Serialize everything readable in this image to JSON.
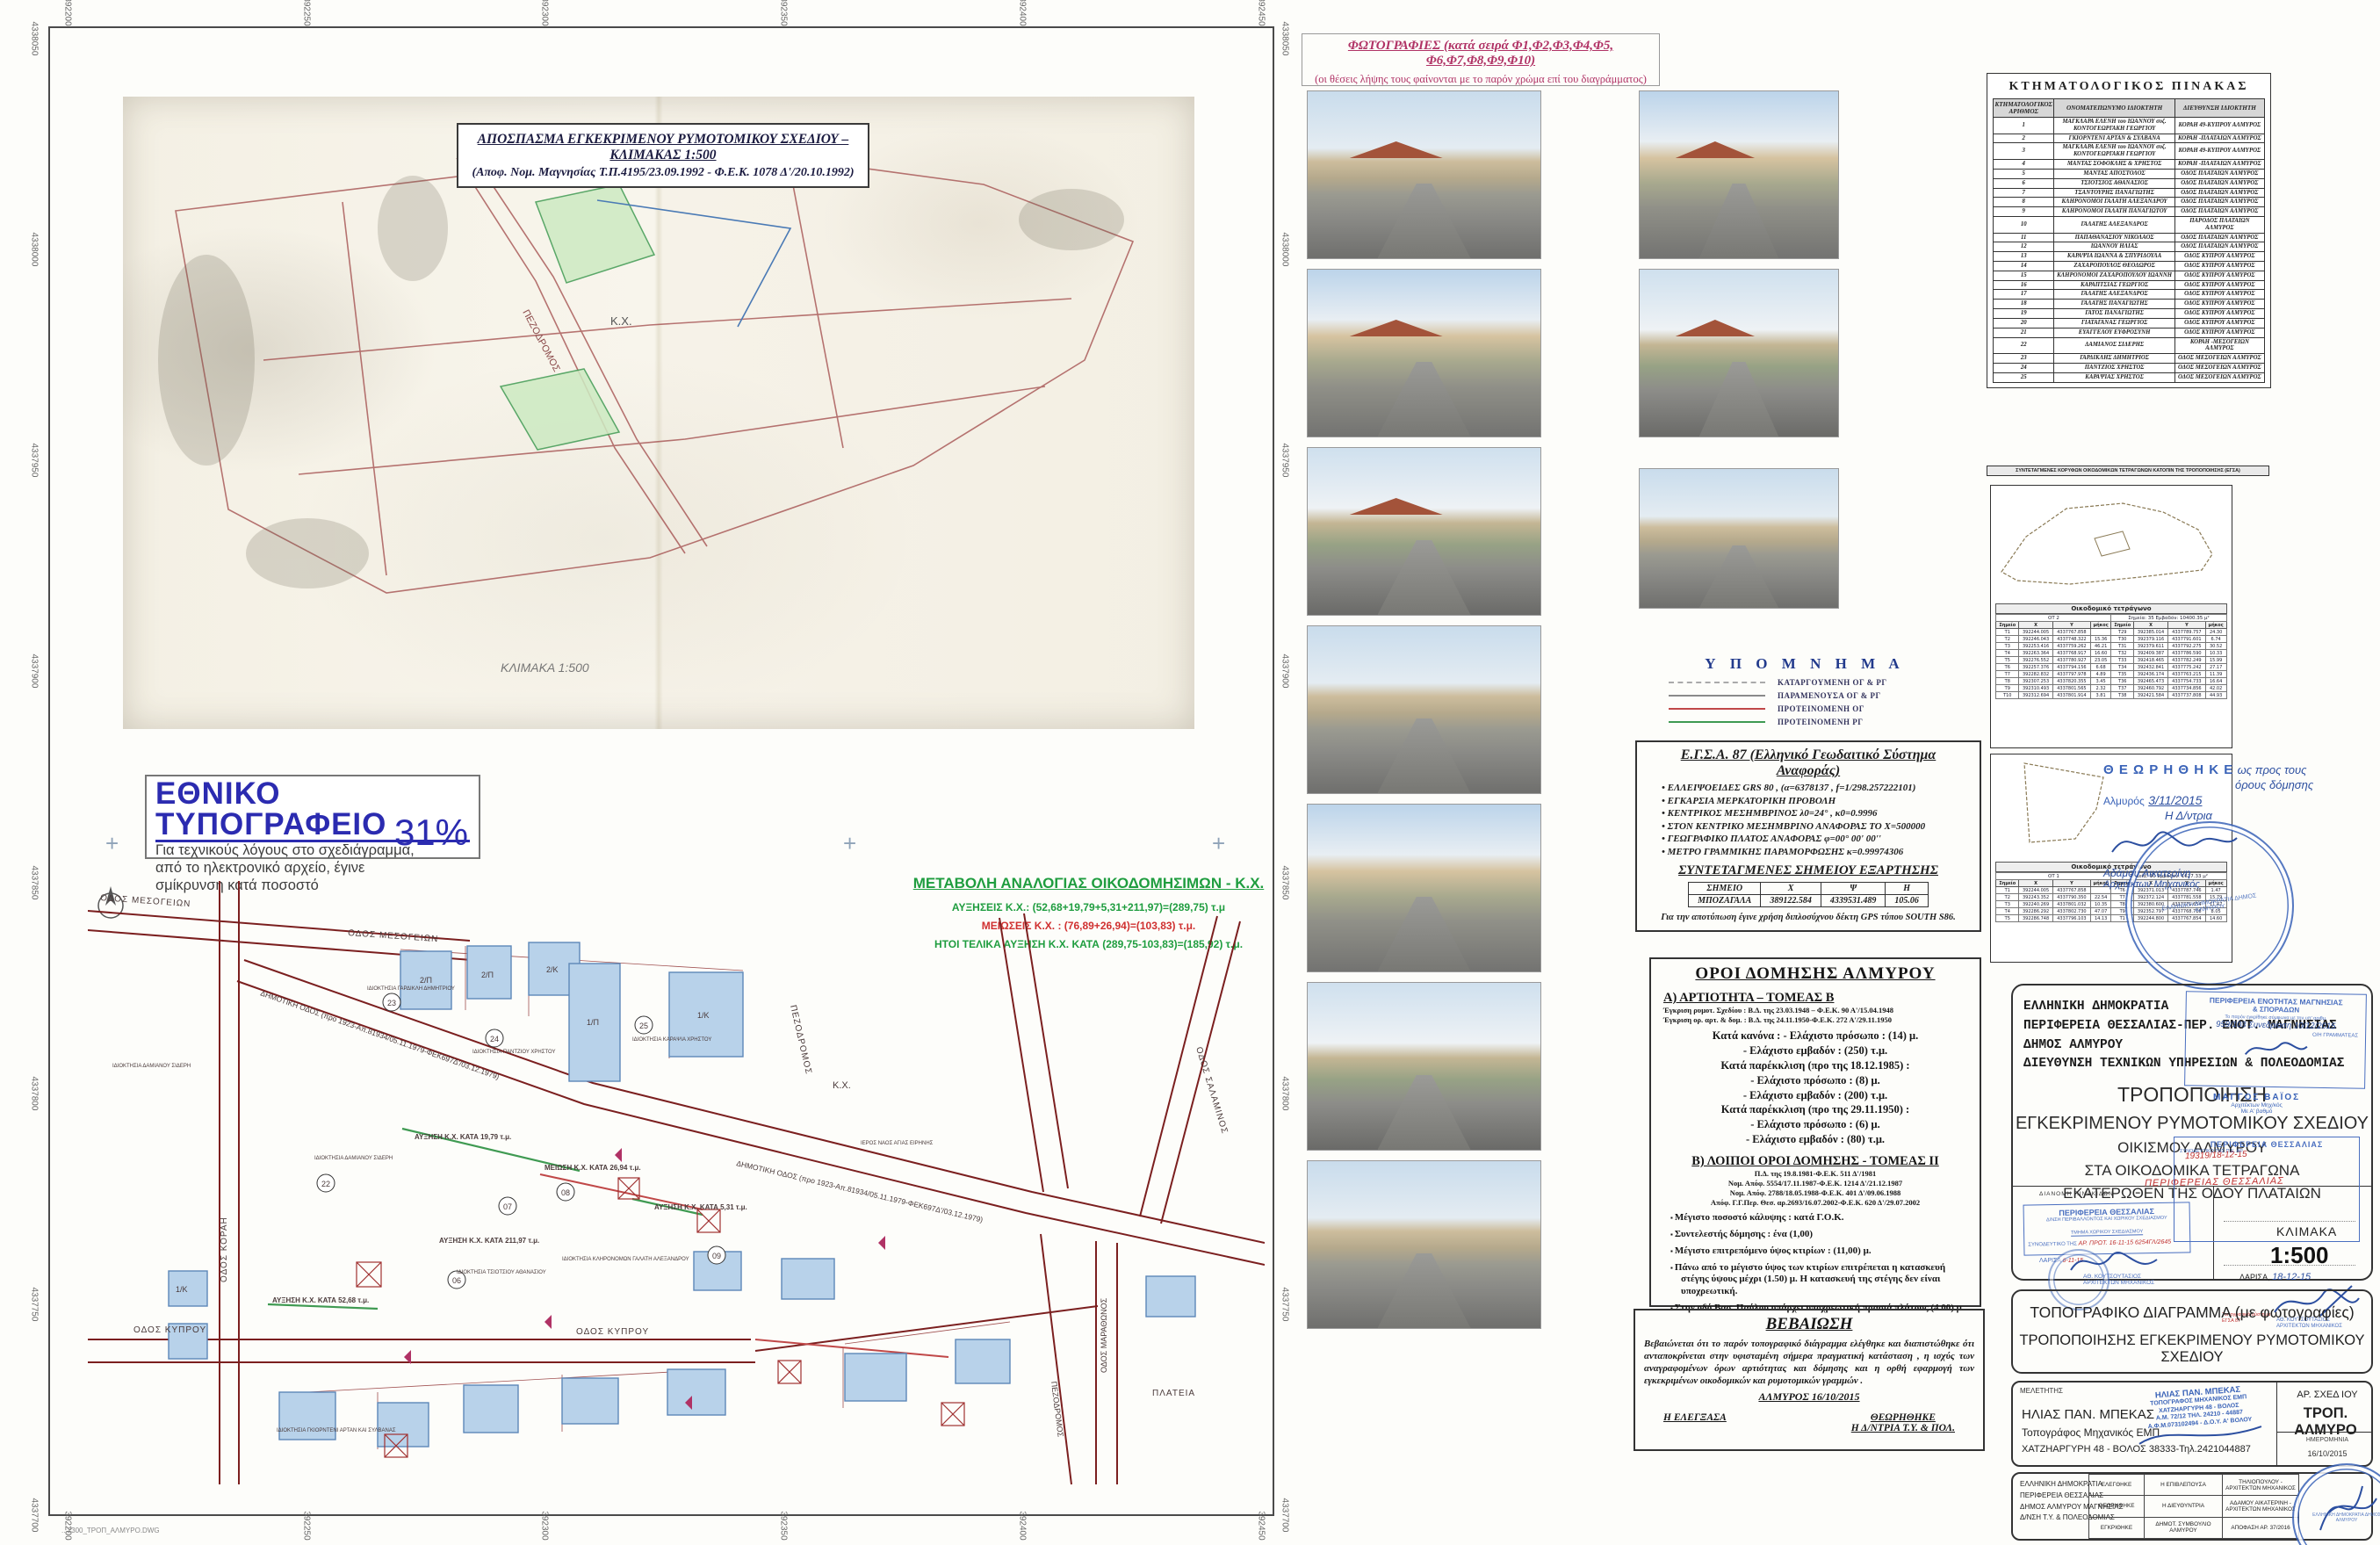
{
  "colors": {
    "proposed_og_red": "#c04848",
    "proposed_rg_green": "#3f9a52",
    "remaining_gray": "#8a8a8a",
    "abolished_gray": "#aaaaaa",
    "accent_green": "#1f9d3f",
    "accent_red": "#d03030",
    "photo_magenta": "#b03265",
    "stamp_blue": "#3a63b8",
    "print_office_blue": "#2b2bb0"
  },
  "frame": {
    "top_coords": [
      "392200",
      "392250",
      "392300",
      "392350",
      "392400",
      "392450"
    ],
    "left_coords": [
      "4338050",
      "4338000",
      "4337950",
      "4337900",
      "4337850",
      "4337800",
      "4337750",
      "4337700"
    ],
    "plot_note": "...2300_ΤΡΟΠ_ΑΛΜΥΡΟ.DWG"
  },
  "excerpt": {
    "title": "ΑΠΟΣΠΑΣΜΑ ΕΓΚΕΚΡΙΜΕΝΟΥ ΡΥΜΟΤΟΜΙΚΟΥ ΣΧΕΔΙΟΥ  –  ΚΛΙΜΑΚΑΣ 1:500",
    "subtitle": "(Αποφ. Νομ. Μαγνησίας Τ.Π.4195/23.09.1992 - Φ.Ε.Κ. 1078 Δ'/20.10.1992)",
    "kx_label": "Κ.Χ.",
    "pezodromos": "ΠΕΖΟΔΡΟΜΟΣ",
    "scale_note": "ΚΛΙΜΑΚΑ 1:500"
  },
  "print_office": {
    "heading": "ΕΘΝΙΚΟ ΤΥΠΟΓΡΑΦΕΙΟ",
    "line1": "Για τεχνικούς λόγους στο σχεδιάγραμμα,",
    "line2": "από το ηλεκτρονικό αρχείο, έγινε",
    "line3": "σμίκρυνση κατά ποσοστό",
    "percent": "31%"
  },
  "metavoli": {
    "title": "ΜΕΤΑΒΟΛΗ ΑΝΑΛΟΓΙΑΣ ΟΙΚΟΔΟΜΗΣΙΜΩΝ - Κ.Χ.",
    "increase": "ΑΥΞΗΣΕΙΣ Κ.Χ.: (52,68+19,79+5,31+211,97)=(289,75) τ.μ",
    "decrease": "ΜΕΙΩΣΕΙΣ Κ.Χ.   :   (76,89+26,94)=(103,83) τ.μ.",
    "total": "ΗΤΟΙ ΤΕΛΙΚΑ ΑΥΞΗΣΗ Κ.Χ. ΚΑΤΑ (289,75-103,83)=(185,92) τ.μ."
  },
  "map": {
    "streets": {
      "mesogeion": "ΟΔΟΣ ΜΕΣΟΓΕΙΩΝ",
      "mesogeion2": "ΟΔΟΣ ΜΕΣΟΓΕΙΩΝ",
      "korai": "ΟΔΟΣ ΚΟΡΑΗ",
      "dimotiki": "ΔΗΜΟΤΙΚΗ ΟΔΟΣ (προ 1923-Απ.81934/05.11.1979-ΦΕΚ697Δ'/03.12.1979)",
      "dimotiki2": "ΔΗΜΟΤΙΚΗ ΟΔΟΣ (προ 1923-Απ.81934/05.11.1979-ΦΕΚ697Δ'/03.12.1979)",
      "pezodromos": "ΠΕΖΟΔΡΟΜΟΣ",
      "pezodromos2": "ΠΕΖΟΔΡΟΜΟΣ",
      "salaminos": "ΟΔΟΣ ΣΑΛΑΜΙΝΟΣ",
      "kyprou": "ΟΔΟΣ ΚΥΠΡΟΥ",
      "kyprou2": "ΟΔΟΣ ΚΥΠΡΟΥ",
      "marathonos": "ΟΔΟΣ ΜΑΡΑΘΩΝΟΣ",
      "plateia": "ΠΛΑΤΕΙΑ",
      "kx": "Κ.Χ."
    },
    "annotations": {
      "inc1": "ΑΥΞΗΣΗ Κ.Χ. ΚΑΤΑ 19,79 τ.μ.",
      "inc2": "ΑΥΞΗΣΗ Κ.Χ. ΚΑΤΑ 5,31 τ.μ.",
      "inc3": "ΑΥΞΗΣΗ Κ.Χ. ΚΑΤΑ 52,68 τ.μ.",
      "inc4": "ΑΥΞΗΣΗ Κ.Χ. ΚΑΤΑ 211,97 τ.μ.",
      "dec1": "ΜΕΙΩΣΗ Κ.Χ. ΚΑΤΑ 26,94 τ.μ.",
      "church": "ΙΕΡΟΣ ΝΑΟΣ ΑΓΙΑΣ ΕΙΡΗΝΗΣ",
      "prop_sideri": "ΙΔΙΟΚΤΗΣΙΑ ΔΑΜΙΑΝΟΥ ΣΙΔΕΡΗ",
      "prop_sideri2": "ΙΔΙΟΚΤΗΣΙΑ ΔΑΜΙΑΝΟΥ ΣΙΔΕΡΗ",
      "prop_gardikli": "ΙΔΙΟΚΤΗΣΙΑ ΓΑΡΔΙΚΛΗ ΔΗΜΗΤΡΙΟΥ",
      "prop_pantziou": "ΙΔΙΟΚΤΗΣΙΑ ΠΑΝΤΖΙΟΥ ΧΡΗΣΤΟΥ",
      "prop_karapsia": "ΙΔΙΟΚΤΗΣΙΑ ΚΑΡΑΨΙΑ ΧΡΗΣΤΟΥ",
      "prop_galati": "ΙΔΙΟΚΤΗΣΙΑ ΚΛΗΡΟΝΟΜΩΝ ΓΑΛΑΤΗ ΑΛΕΞΑΝΔΡΟΥ",
      "prop_tsiotsiou": "ΙΔΙΟΚΤΗΣΙΑ ΤΣΙΟΤΣΙΟΥ ΑΘΑΝΑΣΙΟΥ",
      "prop_gkiornteni": "ΙΔΙΟΚΤΗΣΙΑ ΓΚΙΟΡΝΤΕΝΙ ΑΡΤΑΝ ΚΑΙ ΣΥΛΒΑΝΑΣ"
    },
    "lot_numbers": [
      "06",
      "07",
      "08",
      "09",
      "22",
      "23",
      "24",
      "25"
    ],
    "lot_tags": [
      "2/Π",
      "2/Π",
      "2/Κ",
      "1/Π",
      "1/Κ",
      "1/Κ"
    ]
  },
  "photos": {
    "header": "ΦΩΤΟΓΡΑΦΙΕΣ (κατά σειρά Φ1,Φ2,Φ3,Φ4,Φ5, Φ6,Φ7,Φ8,Φ9,Φ10)",
    "subheader": "(οι θέσεις λήψης τους φαίνονται με το παρόν χρώμα επί του διαγράμματος)"
  },
  "legend": {
    "title": "Υ Π Ο Μ Ν Η Μ Α",
    "items": [
      {
        "label": "ΚΑΤΑΡΓΟΥΜΕΝΗ ΟΓ & ΡΓ"
      },
      {
        "label": "ΠΑΡΑΜΕΝΟΥΣΑ ΟΓ & ΡΓ"
      },
      {
        "label": "ΠΡΟΤΕΙΝΟΜΕΝΗ ΟΓ"
      },
      {
        "label": "ΠΡΟΤΕΙΝΟΜΕΝΗ ΡΓ"
      }
    ]
  },
  "egsa": {
    "title": "Ε.Γ.Σ.Α. 87 (Ελληνικό Γεωδαιτικό Σύστημα Αναφοράς)",
    "bullets": [
      "ΕΛΛΕΙΨΟΕΙΔΕΣ GRS 80 , (α=6378137 , f=1/298.257222101)",
      "ΕΓΚΑΡΣΙΑ ΜΕΡΚΑΤΟΡΙΚΗ ΠΡΟΒΟΛΗ",
      "ΚΕΝΤΡΙΚΟΣ ΜΕΣΗΜΒΡΙΝΟΣ λ0=24° , κ0=0.9996",
      "ΣΤΟΝ ΚΕΝΤΡΙΚΟ ΜΕΣΗΜΒΡΙΝΟ ΑΝΑΦΟΡΑΣ ΤΟ Χ=500000",
      "ΓΕΩΓΡΑΦΙΚΟ ΠΛΑΤΟΣ ΑΝΑΦΟΡΑΣ  φ=00° 00' 00''",
      "ΜΕΤΡΟ ΓΡΑΜΜΙΚΗΣ ΠΑΡΑΜΟΡΦΩΣΗΣ  κ=0.99974306"
    ],
    "coords_title": "ΣΥΝΤΕΤΑΓΜΕΝΕΣ ΣΗΜΕΙΟΥ ΕΞΑΡΤΗΣΗΣ",
    "table": {
      "h0": "ΣΗΜΕΙΟ",
      "h1": "Χ",
      "h2": "Ψ",
      "h3": "Η",
      "r0": "ΜΠΟΖΑΓΑΛΑ",
      "r1": "389122.584",
      "r2": "4339531.489",
      "r3": "105.06"
    },
    "note": "Για την αποτύπωση έγινε χρήση διπλοσύχνου δέκτη GPS τύπου SOUTH S86."
  },
  "oroi": {
    "title": "ΟΡΟΙ ΔΟΜΗΣΗΣ ΑΛΜΥΡΟΥ",
    "sectionA_title": "Α) ΑΡΤΙΟΤΗΤΑ – ΤΟΜΕΑΣ Β",
    "sectionA_refs": [
      "Έγκριση ρυμοτ. Σχεδίου : Β.Δ. της 23.03.1948 – Φ.Ε.Κ. 90 Α'/15.04.1948",
      "Έγκριση ορ. αρτ. & δομ. : Β.Δ. της 24.11.1950-Φ.Ε.Κ. 272 Α'/29.11.1950"
    ],
    "rules": [
      "Κατά κανόνα : - Ελάχιστο πρόσωπο  : (14) μ.",
      "- Ελάχιστο εμβαδόν    : (250) τ.μ.",
      "Κατά παρέκκλιση (προ της 18.12.1985)  :",
      "- Ελάχιστο πρόσωπο  : (8) μ.",
      "- Ελάχιστο εμβαδόν    : (200) τ.μ.",
      "Κατά παρέκκλιση (προ της 29.11.1950)  :",
      "- Ελάχιστο πρόσωπο  : (6) μ.",
      "- Ελάχιστο εμβαδόν  : (80) τ.μ."
    ],
    "sectionB_title": "Β) ΛΟΙΠΟΙ ΟΡΟΙ ΔΟΜΗΣΗΣ - ΤΟΜΕΑΣ ΙΙ",
    "sectionB_refs": [
      "Π.Δ. της 19.8.1981-Φ.Ε.Κ. 511 Δ'/1981",
      "Νομ. Απόφ. 5554/17.11.1987-Φ.Ε.Κ. 1214 Δ'/21.12.1987",
      "Νομ. Απόφ. 2788/18.05.1988-Φ.Ε.Κ.  401 Δ'/09.06.1988",
      "Απόφ. Γ.Γ.Περ. Θεσ. αρ.2693/16.07.2002-Φ.Ε.Κ. 620 Δ'/29.07.2002"
    ],
    "sectionB_bullets": [
      "Μέγιστο ποσοστό κάλυψης : κατά Γ.Ο.Κ.",
      "Συντελεστής δόμησης :  ένα (1,00)",
      "Μέγιστο επιτρεπόμενο ύψος κτιρίων : (11,00) μ.",
      "Πάνω από το μέγιστο ύψος των κτιρίων επιτρέπεται η κατασκευή στέγης ύψους μέχρι (1.50) μ.  Η κατασκευή της στέγης δεν είναι υποχρεωτική.",
      "Στην οδό Βασ. Παύλου υπάρχει υποχρεωτική πρασιά πλάτους  (4.00) μ."
    ]
  },
  "vevaiosi": {
    "title": "ΒΕΒΑΙΩΣΗ",
    "body": "Βεβαιώνεται ότι το παρόν τοπογραφικό διάγραμμα ελέγθηκε και διαπιστώθηκε ότι ανταποκρίνεται στην υφισταμένη σήμερα πραγματική κατάσταση , η ισχύς των αναγραφομένων όρων αρτιότητας και δόμησης και η ορθή εφαρμογή των εγκεκριμένων οικοδομικών και ρυμοτομικών γραμμών .",
    "place_date": "ΑΛΜΥΡΟΣ  16/10/2015",
    "left_sign": "Η  ΕΛΕΓΞΑΣΑ",
    "right_sign1": "ΘΕΩΡΗΘΗΚΕ",
    "right_sign2": "Η  Δ/ΝΤΡΙΑ Τ.Υ. & ΠΟΛ."
  },
  "ktimatologikos": {
    "title": "ΚΤΗΜΑΤΟΛΟΓΙΚΟΣ   ΠΙΝΑΚΑΣ",
    "h0": "ΚΤΗΜΑΤΟΛΟΓΙΚΟΣ ΑΡΙΘΜΟΣ",
    "h1": "ΟΝΟΜΑΤΕΠΩΝΥΜΟ ΙΔΙΟΚΤΗΤΗ",
    "h2": "ΔΙΕΥΘΥΝΣΗ ΙΔΙΟΚΤΗΤΗ",
    "rows": [
      {
        "n": "1",
        "owner": "ΜΑΓΚΛΑΡΑ ΕΛΕΝΗ του ΙΩΑΝΝΟΥ συζ. ΚΟΝΤΟΓΕΩΡΓΑΚΗ ΓΕΩΡΓΙΟΥ",
        "addr": "ΚΟΡΑΗ 49-ΚΥΠΡΟΥ ΑΛΜΥΡΟΣ"
      },
      {
        "n": "2",
        "owner": "ΓΚΙΟΡΝΤΕΝΙ ΑΡΤΑΝ & ΣΥΛΒΑΝΑ",
        "addr": "ΚΟΡΑΗ -ΠΛΑΤΑΙΩΝ ΑΛΜΥΡΟΣ"
      },
      {
        "n": "3",
        "owner": "ΜΑΓΚΛΑΡΑ ΕΛΕΝΗ του ΙΩΑΝΝΟΥ συζ. ΚΟΝΤΟΓΕΩΡΓΑΚΗ ΓΕΩΡΓΙΟΥ",
        "addr": "ΚΟΡΑΗ 49-ΚΥΠΡΟΥ ΑΛΜΥΡΟΣ"
      },
      {
        "n": "4",
        "owner": "ΜΑΝΤΑΣ ΣΟΦΟΚΛΗΣ & ΧΡΗΣΤΟΣ",
        "addr": "ΚΟΡΑΗ -ΠΛΑΤΑΙΩΝ ΑΛΜΥΡΟΣ"
      },
      {
        "n": "5",
        "owner": "ΜΑΝΤΑΣ ΑΠΟΣΤΟΛΟΣ",
        "addr": "ΟΔΟΣ ΠΛΑΤΑΙΩΝ ΑΛΜΥΡΟΣ"
      },
      {
        "n": "6",
        "owner": "ΤΣΙΟΤΣΙΟΣ ΑΘΑΝΑΣΙΟΣ",
        "addr": "ΟΔΟΣ ΠΛΑΤΑΙΩΝ ΑΛΜΥΡΟΣ"
      },
      {
        "n": "7",
        "owner": "ΤΣΑΝΤΟΥΡΗΣ ΠΑΝΑΓΙΩΤΗΣ",
        "addr": "ΟΔΟΣ ΠΛΑΤΑΙΩΝ ΑΛΜΥΡΟΣ"
      },
      {
        "n": "8",
        "owner": "ΚΛΗΡΟΝΟΜΟΙ ΓΑΛΑΤΗ ΑΛΕΞΑΝΔΡΟΥ",
        "addr": "ΟΔΟΣ ΠΛΑΤΑΙΩΝ ΑΛΜΥΡΟΣ"
      },
      {
        "n": "9",
        "owner": "ΚΛΗΡΟΝΟΜΟΙ ΓΑΛΑΤΗ ΠΑΝΑΓΙΩΤΟΥ",
        "addr": "ΟΔΟΣ ΠΛΑΤΑΙΩΝ ΑΛΜΥΡΟΣ"
      },
      {
        "n": "10",
        "owner": "ΓΑΛΑΤΗΣ ΑΛΕΞΑΝΔΡΟΣ",
        "addr": "ΠΑΡΟΔΟΣ ΠΛΑΤΑΙΩΝ ΑΛΜΥΡΟΣ"
      },
      {
        "n": "11",
        "owner": "ΠΑΠΑΘΑΝΑΣΙΟΥ ΝΙΚΟΛΑΟΣ",
        "addr": "ΟΔΟΣ ΠΛΑΤΑΙΩΝ ΑΛΜΥΡΟΣ"
      },
      {
        "n": "12",
        "owner": "ΙΩΑΝΝΟΥ ΗΛΙΑΣ",
        "addr": "ΟΔΟΣ ΠΛΑΤΑΙΩΝ ΑΛΜΥΡΟΣ"
      },
      {
        "n": "13",
        "owner": "ΚΑΡΑΨΙΑ ΙΩΑΝΝΑ & ΣΠΥΡΙΔΟΥΛΑ",
        "addr": "ΟΔΟΣ ΚΥΠΡΟΥ ΑΛΜΥΡΟΣ"
      },
      {
        "n": "14",
        "owner": "ΖΑΧΑΡΟΠΟΥΛΟΣ ΘΕΟΔΩΡΟΣ",
        "addr": "ΟΔΟΣ ΚΥΠΡΟΥ ΑΛΜΥΡΟΣ"
      },
      {
        "n": "15",
        "owner": "ΚΛΗΡΟΝΟΜΟΙ ΖΑΧΑΡΟΠΟΥΛΟΥ ΙΩΑΝΝΗ",
        "addr": "ΟΔΟΣ ΚΥΠΡΟΥ ΑΛΜΥΡΟΣ"
      },
      {
        "n": "16",
        "owner": "ΚΑΡΑΠΤΣΙΑΣ ΓΕΩΡΓΙΟΣ",
        "addr": "ΟΔΟΣ ΚΥΠΡΟΥ ΑΛΜΥΡΟΣ"
      },
      {
        "n": "17",
        "owner": "ΓΑΛΑΤΗΣ ΑΛΕΞΑΝΔΡΟΣ",
        "addr": "ΟΔΟΣ ΚΥΠΡΟΥ ΑΛΜΥΡΟΣ"
      },
      {
        "n": "18",
        "owner": "ΓΑΛΑΤΗΣ ΠΑΝΑΓΙΩΤΗΣ",
        "addr": "ΟΔΟΣ ΚΥΠΡΟΥ ΑΛΜΥΡΟΣ"
      },
      {
        "n": "19",
        "owner": "ΓΑΤΟΣ ΠΑΝΑΓΙΩΤΗΣ",
        "addr": "ΟΔΟΣ ΚΥΠΡΟΥ ΑΛΜΥΡΟΣ"
      },
      {
        "n": "20",
        "owner": "ΓΙΑΤΑΓΑΝΑΣ ΓΕΩΡΓΙΟΣ",
        "addr": "ΟΔΟΣ ΚΥΠΡΟΥ ΑΛΜΥΡΟΣ"
      },
      {
        "n": "21",
        "owner": "ΕΥΑΓΓΕΛΟΥ ΕΥΦΡΟΣΥΝΗ",
        "addr": "ΟΔΟΣ ΚΥΠΡΟΥ ΑΛΜΥΡΟΣ"
      },
      {
        "n": "22",
        "owner": "ΔΑΜΙΑΝΟΣ ΣΙΔΕΡΗΣ",
        "addr": "ΚΟΡΑΗ -ΜΕΣΟΓΕΙΩΝ ΑΛΜΥΡΟΣ"
      },
      {
        "n": "23",
        "owner": "ΓΑΡΔΙΚΛΗΣ ΔΗΜΗΤΡΙΟΣ",
        "addr": "ΟΔΟΣ ΜΕΣΟΓΕΙΩΝ ΑΛΜΥΡΟΣ"
      },
      {
        "n": "24",
        "owner": "ΠΑΝΤΖΙΟΣ ΧΡΗΣΤΟΣ",
        "addr": "ΟΔΟΣ ΜΕΣΟΓΕΙΩΝ ΑΛΜΥΡΟΣ"
      },
      {
        "n": "25",
        "owner": "ΚΑΡΑΨΙΑΣ ΧΡΗΣΤΟΣ",
        "addr": "ΟΔΟΣ ΜΕΣΟΓΕΙΩΝ ΑΛΜΥΡΟΣ"
      }
    ],
    "footer": "ΣΥΝΤΕΤΑΓΜΕΝΕΣ ΚΟΡΥΦΩΝ ΟΙΚΟΔΟΜΙΚΩΝ ΤΕΤΡΑΓΩΝΩΝ ΚΑΤΟΠΙΝ ΤΗΣ ΤΡΟΠΟΠΟΙΗΣΗΣ (ΕΓΣΑ)"
  },
  "ot_panels": {
    "p1": {
      "caption": "Οικοδομικό τετράγωνο",
      "info_left": "ΟΤ 2",
      "info_right": "Σημεία: 35     Εμβαδόν: 10400.35 μ²",
      "h_point": "Σημείο",
      "h_x": "Χ",
      "h_y": "Υ",
      "h_len": "μήκος",
      "rows_a": [
        {
          "p": "Τ1",
          "x": "392244.005",
          "y": "4337767.858",
          "l": ""
        },
        {
          "p": "Τ2",
          "x": "392246.043",
          "y": "4337748.322",
          "l": "15.36"
        },
        {
          "p": "Τ3",
          "x": "392253.416",
          "y": "4337759.262",
          "l": "46.21"
        },
        {
          "p": "Τ4",
          "x": "392263.364",
          "y": "4337768.917",
          "l": "16.60"
        },
        {
          "p": "Τ5",
          "x": "392276.552",
          "y": "4337780.927",
          "l": "23.05"
        },
        {
          "p": "Τ6",
          "x": "392257.376",
          "y": "4337794.156",
          "l": "6.68"
        },
        {
          "p": "Τ7",
          "x": "392282.832",
          "y": "4337797.978",
          "l": "4.89"
        },
        {
          "p": "Τ8",
          "x": "392307.253",
          "y": "4337820.355",
          "l": "3.45"
        },
        {
          "p": "Τ9",
          "x": "392310.493",
          "y": "4337801.565",
          "l": "2.32"
        },
        {
          "p": "Τ10",
          "x": "392312.694",
          "y": "4337801.914",
          "l": "3.81"
        }
      ],
      "rows_b": [
        {
          "p": "Τ29",
          "x": "392385.014",
          "y": "4337789.757",
          "l": "24.30"
        },
        {
          "p": "Τ30",
          "x": "392379.116",
          "y": "4337791.601",
          "l": "6.74"
        },
        {
          "p": "Τ31",
          "x": "392379.611",
          "y": "4337792.275",
          "l": "30.52"
        },
        {
          "p": "Τ32",
          "x": "392409.387",
          "y": "4337786.590",
          "l": "10.33"
        },
        {
          "p": "Τ33",
          "x": "392418.465",
          "y": "4337782.249",
          "l": "15.99"
        },
        {
          "p": "Τ34",
          "x": "392432.841",
          "y": "4337775.242",
          "l": "27.17"
        },
        {
          "p": "Τ35",
          "x": "392436.174",
          "y": "4337763.215",
          "l": "11.39"
        },
        {
          "p": "Τ36",
          "x": "392465.473",
          "y": "4337754.733",
          "l": "16.64"
        },
        {
          "p": "Τ37",
          "x": "392460.792",
          "y": "4337734.856",
          "l": "42.02"
        },
        {
          "p": "Τ38",
          "x": "392421.584",
          "y": "4337737.808",
          "l": "44.93"
        }
      ]
    },
    "p2": {
      "caption": "Οικοδομικό τετράγωνο",
      "info_left": "ΟΤ 1",
      "info_right": "Σημεία: 10     Εμβαδόν: 1627.33 μ²",
      "h_point": "Σημείο",
      "h_x": "Χ",
      "h_y": "Υ",
      "h_len": "μήκος",
      "rows_a": [
        {
          "p": "Τ1",
          "x": "392244.005",
          "y": "4337767.858",
          "l": ""
        },
        {
          "p": "Τ2",
          "x": "392243.352",
          "y": "4337790.350",
          "l": "22.54"
        },
        {
          "p": "Τ3",
          "x": "392240.269",
          "y": "4337801.032",
          "l": "10.35"
        },
        {
          "p": "Τ4",
          "x": "392286.292",
          "y": "4337802.730",
          "l": "47.07"
        },
        {
          "p": "Τ5",
          "x": "392286.748",
          "y": "4337796.103",
          "l": "14.13"
        }
      ],
      "rows_b": [
        {
          "p": "Τ6",
          "x": "392371.013",
          "y": "4337787.746",
          "l": "1.47"
        },
        {
          "p": "Τ7",
          "x": "392372.124",
          "y": "4337781.558",
          "l": "15.79"
        },
        {
          "p": "Τ8",
          "x": "392380.600",
          "y": "4337771.654",
          "l": "11.47"
        },
        {
          "p": "Τ9",
          "x": "392352.797",
          "y": "4337768.718",
          "l": "8.05"
        },
        {
          "p": "Τ1",
          "x": "392244.800",
          "y": "4337767.854",
          "l": "14.60"
        }
      ]
    }
  },
  "theorisi": {
    "line1": "Θ Ε Ω Ρ Η Θ Η Κ Ε",
    "hand1": "ως προς τους",
    "hand2": "όρους δόμησης",
    "line2": "Αλμυρός",
    "hand_date": "3/11/2015",
    "line3": "Η Δ/ντρια",
    "name": "Αδάμου Αικατερίνη",
    "title": "Αρχιτέκτων Μηχανικός",
    "stamp_text": "ΕΛΛΗΝΙΚΗ ΔΗΜΟΚΡΑΤΙΑ ΔΗΜΟΣ ΑΛΜΥΡΟΥ"
  },
  "title_block": {
    "agency_lines": [
      "ΕΛΛΗΝΙΚΗ ΔΗΜΟΚΡΑΤΙΑ",
      "ΠΕΡΙΦΕΡΕΙΑ ΘΕΣΣΑΛΙΑΣ-ΠΕΡ. ΕΝΟΤ. ΜΑΓΝΗΣΙΑΣ",
      "ΔΗΜΟΣ ΑΛΜΥΡΟΥ",
      "ΔΙΕΥΘΥΝΣΗ ΤΕΧΝΙΚΩΝ ΥΠΗΡΕΣΙΩΝ & ΠΟΛΕΟΔΟΜΙΑΣ"
    ],
    "main_title1": "ΤΡΟΠΟΠΟΙΗΣΗ",
    "main_title2": "ΕΓΚΕΚΡΙΜΕΝΟΥ ΡΥΜΟΤΟΜΙΚΟΥ ΣΧΕΔΙΟΥ",
    "main_title3": "ΟΙΚΙΣΜΟΥ ΑΛΜΥΡΟΥ",
    "main_title4": "ΣΤΑ ΟΙΚΟΔΟΜΙΚΑ ΤΕΤΡΑΓΩΝΑ",
    "main_title5": "ΕΚΑΤΕΡΩΘΕΝ ΤΗΣ ΟΔΟΥ ΠΛΑΤΑΙΩΝ",
    "dianomi": "ΔΙΑΝΟΜΗ ΠΙΝΑΚΙΔΩΝ",
    "scale_label": "ΚΛΙΜΑΚΑ",
    "scale_value": "1:500",
    "scale_place": "ΛΑΡΙΣΑ, ",
    "scale_date_hand": "18-12-15",
    "stamp_magnisias1": "ΠΕΡΙΦΕΡΕΙΑ ΕΝΟΤΗΤΑΣ ΜΑΓΝΗΣΙΑΣ",
    "stamp_magnisias2": "& ΣΠΟΡΑΔΩΝ",
    "stamp_magnisias3": "Το παρόν εγκρίθηκε σύμφωνα με την υπ' αριθμ.",
    "stamp_magnisias_hand": "959/103 Συνεδρίαση  10/12/2015",
    "stamp_magnisias4": "Ο/Η ΓΡΑΜΜΑΤΕΑΣ",
    "maggos1": "ΜΑΓΓΟΣ ΒΑΪΟΣ",
    "maggos2": "Αρχιτέκτων Μηχ/κός",
    "maggos3": "Με Α' βαθμό",
    "red_hand1": "19319/18-12-15",
    "red_hand2": "ΠΕΡΙΦΕΡΕΙΑΣ  ΘΕΣΣΑΛΙΑΣ",
    "stamp_thessalias1": "ΠΕΡΙΦΕΡΕΙΑ  ΘΕΣΣΑΛΙΑΣ",
    "stamp_thessalias2": "ΣΥΝΟΔΕΥΤΙΚΟ ΤΗΣ Π.Ε. ΑΡ.",
    "stamp_left1": "ΠΕΡΙΦΕΡΕΙΑ  ΘΕΣΣΑΛΙΑΣ",
    "stamp_left2": "Δ/ΝΣΗ ΠΕΡΙΒΑΛΛΟΝΤΟΣ ΚΑΙ ΧΩΡΙΚΟΥ ΣΧΕΔΙΑΣΜΟΥ",
    "stamp_left3": "ΤΜΗΜΑ ΧΩΡΙΚΟΥ ΣΧΕΔΙΑΣΜΟΥ",
    "stamp_left4": "ΣΥΝΟΔΕΥΤΙΚΟ ΤΗΣ",
    "stamp_left_hand": "ΑΡ. ΠΡΩΤ. 16-11-15  6254ΓΛ/2645",
    "stamp_left5": "ΛΑΡΙΣΑ",
    "stamp_left_hand2": "6-11-15",
    "sign_name": "ΑΘ. ΚΟΥΤΣΟΥΤΑΣΙΟΣ",
    "sign_title": "ΑΡΧΙΤΕΚΤΩΝ ΜΗΧΑΝΙΚΟΣ",
    "egsa_note1": "Τοπογραφικό σύστημα",
    "egsa_note2": "ΕΓΣΑ 87",
    "doc_type1": "ΤΟΠΟΓΡΑΦΙΚΟ ΔΙΑΓΡΑΜΜΑ (με φωτογραφίες)",
    "doc_type2": "ΤΡΟΠΟΠΟΙΗΣΗΣ ΕΓΚΕΚΡΙΜΕΝΟΥ ΡΥΜΟΤΟΜΙΚΟΥ ΣΧΕΔΙΟΥ",
    "meletitis_label": "ΜΕΛΕΤΗΤΗΣ",
    "meletitis_name": "ΗΛΙΑΣ  ΠΑΝ.  ΜΠΕΚΑΣ",
    "meletitis_title": "Τοπογράφος Μηχανικός ΕΜΠ",
    "meletitis_addr": "ΧΑΤΖΗΑΡΓΥΡΗ 48 - ΒΟΛΟΣ 38333-Τηλ.2421044887",
    "meletitis_stamp1": "ΗΛΙΑΣ ΠΑΝ. ΜΠΕΚΑΣ",
    "meletitis_stamp2": "ΤΟΠΟΓΡΑΦΟΣ ΜΗΧΑΝΙΚΟΣ ΕΜΠ",
    "meletitis_stamp3": "ΧΑΤΖΗΑΡΓΥΡΗ 48 - ΒΟΛΟΣ",
    "meletitis_stamp4": "Α.Μ. 72/12  ΤΗΛ. 24210 - 44887",
    "meletitis_stamp5": "Α.Φ.Μ.073102494 - Δ.Ο.Υ. Α' ΒΟΛΟΥ",
    "drawing_no_label": "ΑΡ. ΣΧΕΔ ΙΟΥ",
    "drawing_no": "ΤΡΟΠ. ΑΛΜΥΡΟ",
    "date_label": "ΗΜΕΡΟΜΗΝΙΑ",
    "date_value": "16/10/2015",
    "approval_agency": [
      "ΕΛΛΗΝΙΚΗ ΔΗΜΟΚΡΑΤΙΑ",
      "ΠΕΡΙΦΕΡΕΙΑ ΘΕΣΣΑΛΙΑΣ",
      "ΔΗΜΟΣ ΑΛΜΥΡΟΥ ΜΑΓΝΗΣΙΑΣ",
      "Δ/ΝΣΗ Τ.Υ. & ΠΟΛΕΟΔΟΜΙΑΣ"
    ],
    "approval_rows": [
      {
        "status": "ΕΛΕΓΘΗΚΕ",
        "role": "Η ΕΠΙΒΛΕΠΟΥΣΑ",
        "person": "ΤΗΛΙΟΠΟΥΛΟΥ - ΑΡΧΙΤΕΚΤΩΝ ΜΗΧΑΝΙΚΟΣ"
      },
      {
        "status": "ΘΕΩΡΗΘΗΚΕ",
        "role": "Η ΔΙΕΥΘΥΝΤΡΙΑ",
        "person": "ΑΔΑΜΟΥ ΑΙΚΑΤΕΡΙΝΗ - ΑΡΧΙΤΕΚΤΩΝ ΜΗΧΑΝΙΚΟΣ"
      },
      {
        "status": "ΕΓΚΡΙΘΗΚΕ",
        "role": "ΔΗΜΟΤ. ΣΥΜΒΟΥΛΙΟ ΑΛΜΥΡΟΥ",
        "person": "ΑΠΟΦΑΣΗ ΑΡ. 37/2016"
      }
    ]
  }
}
